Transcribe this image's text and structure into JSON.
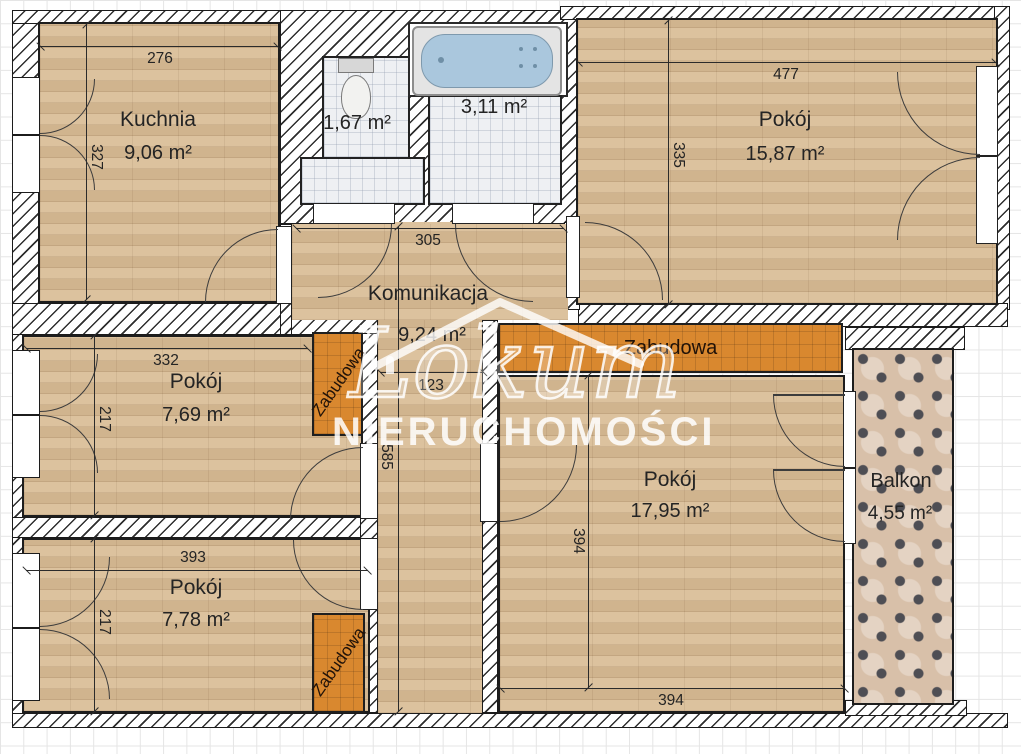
{
  "watermark": {
    "brand": "Lokum",
    "subtitle": "NIERUCHOMOŚCI"
  },
  "rooms": {
    "kuchnia": {
      "name": "Kuchnia",
      "area": "9,06 m²",
      "dim_w": "276",
      "dim_h": "327"
    },
    "wc": {
      "area": "1,67 m²"
    },
    "lazienka": {
      "area": "3,11 m²"
    },
    "pokoj_a": {
      "name": "Pokój",
      "area": "15,87 m²",
      "dim_w": "477",
      "dim_h": "335"
    },
    "komunikacja": {
      "name": "Komunikacja",
      "area": "9,24 m²",
      "dim_w": "305",
      "dim_corridor_w": "123",
      "dim_corridor_h": "585"
    },
    "pokoj_b": {
      "name": "Pokój",
      "area": "7,69 m²",
      "dim_w": "332",
      "dim_h": "217"
    },
    "pokoj_c": {
      "name": "Pokój",
      "area": "7,78 m²",
      "dim_w": "393",
      "dim_h": "217"
    },
    "pokoj_d": {
      "name": "Pokój",
      "area": "17,95 m²",
      "dim_w": "394",
      "dim_h": "394"
    },
    "balkon": {
      "name": "Balkon",
      "area": "4,55 m²"
    }
  },
  "builtins": {
    "label": "Zabudowa"
  },
  "colors": {
    "floor_wood": "#d9bd97",
    "builtin_orange": "#d9882f",
    "tub_blue": "#aac7dd",
    "tile_light": "#eef0f3",
    "balcony_tile": "#d8c0a9",
    "wall_black": "#1d1d1d"
  }
}
